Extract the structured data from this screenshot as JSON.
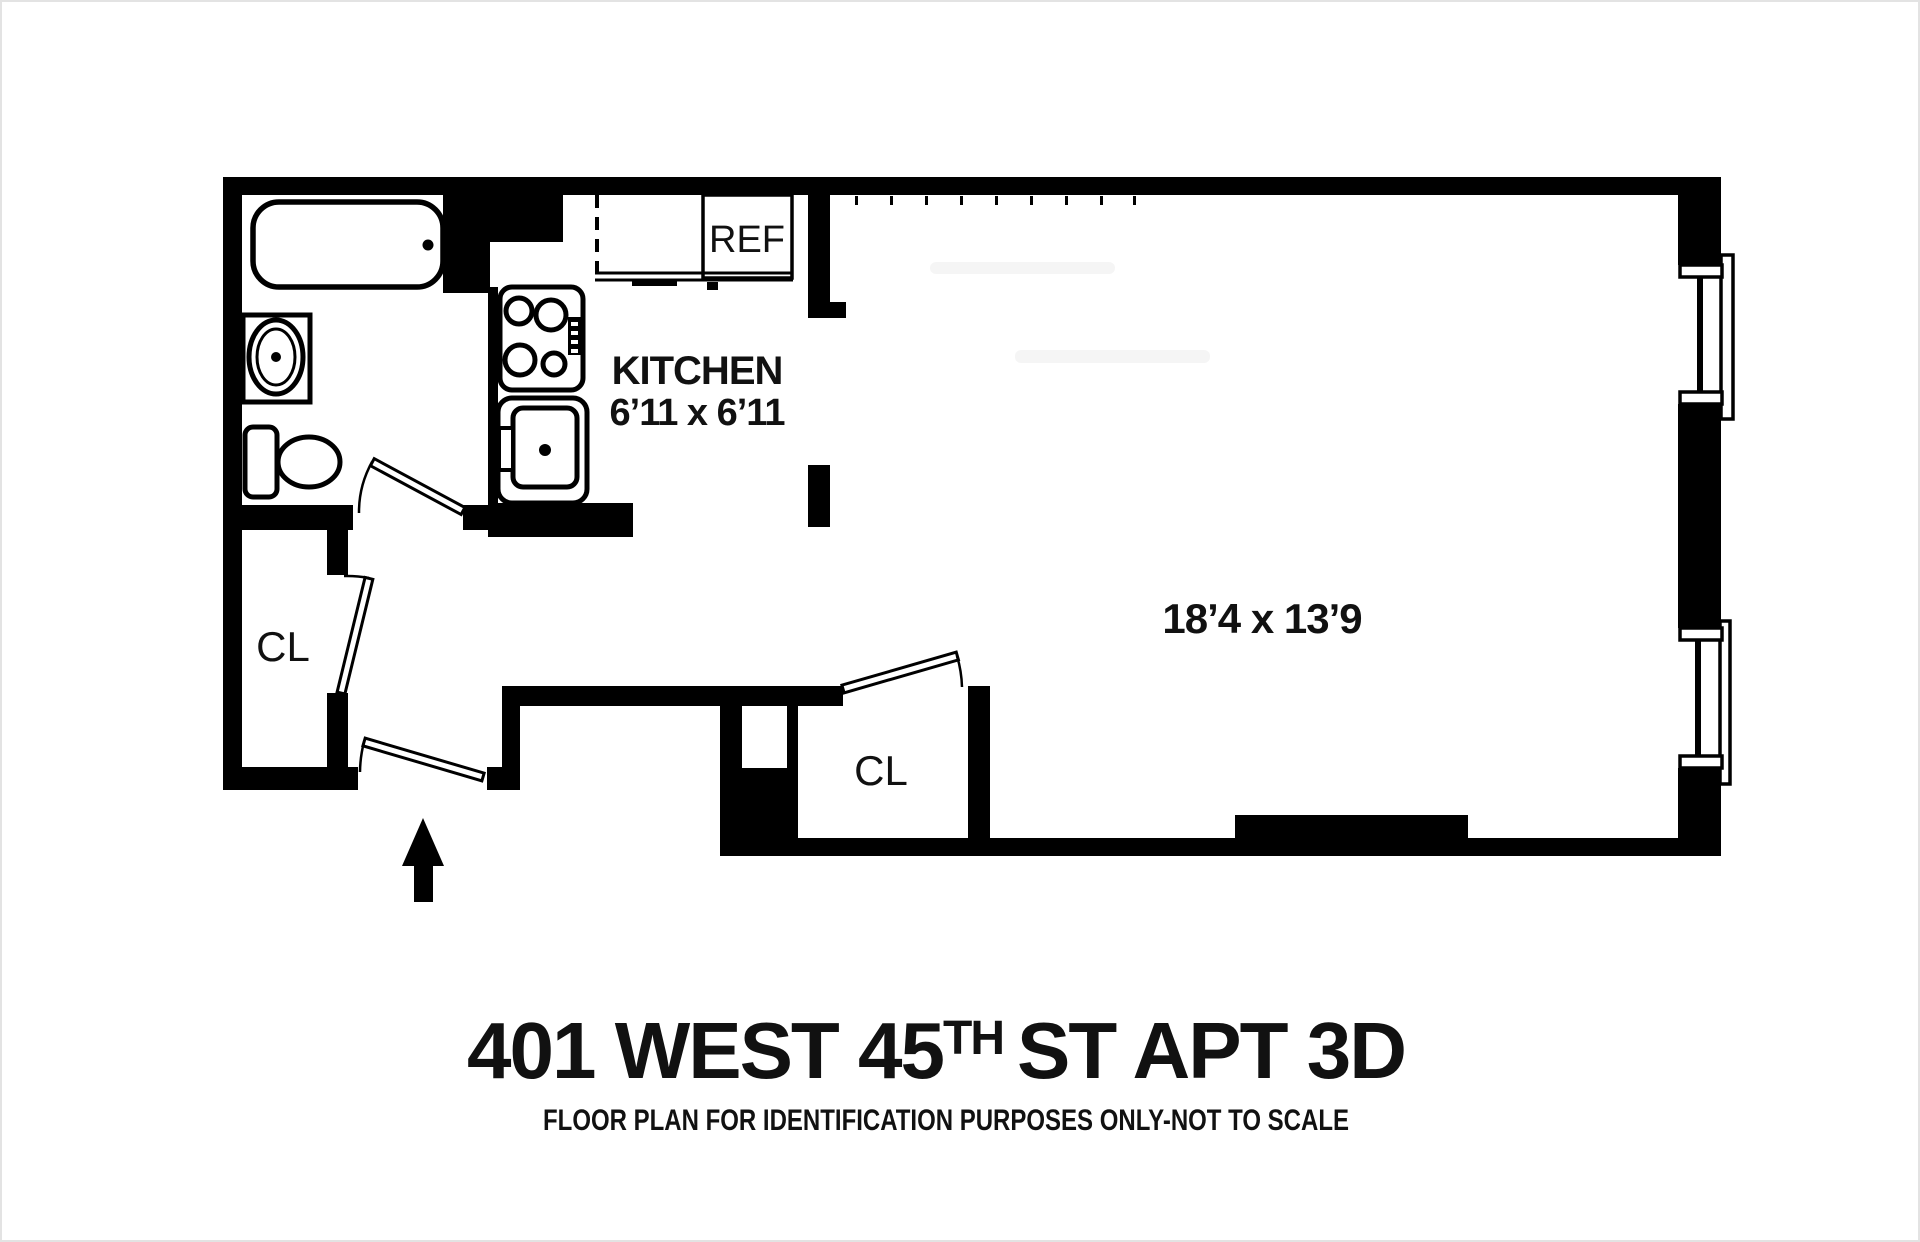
{
  "floor_plan": {
    "title": {
      "main": "401 WEST 45",
      "superscript": "TH",
      "rest": "ST APT 3D"
    },
    "subtitle": "FLOOR PLAN FOR IDENTIFICATION PURPOSES ONLY-NOT TO SCALE",
    "labels": {
      "kitchen": "KITCHEN",
      "kitchen_dims": "6’11 x 6’11",
      "living_dims": "18’4 x 13’9",
      "refrigerator": "REF",
      "closet_left": "CL",
      "closet_middle": "CL"
    },
    "colors": {
      "wall": "#000000",
      "background": "#ffffff"
    }
  }
}
